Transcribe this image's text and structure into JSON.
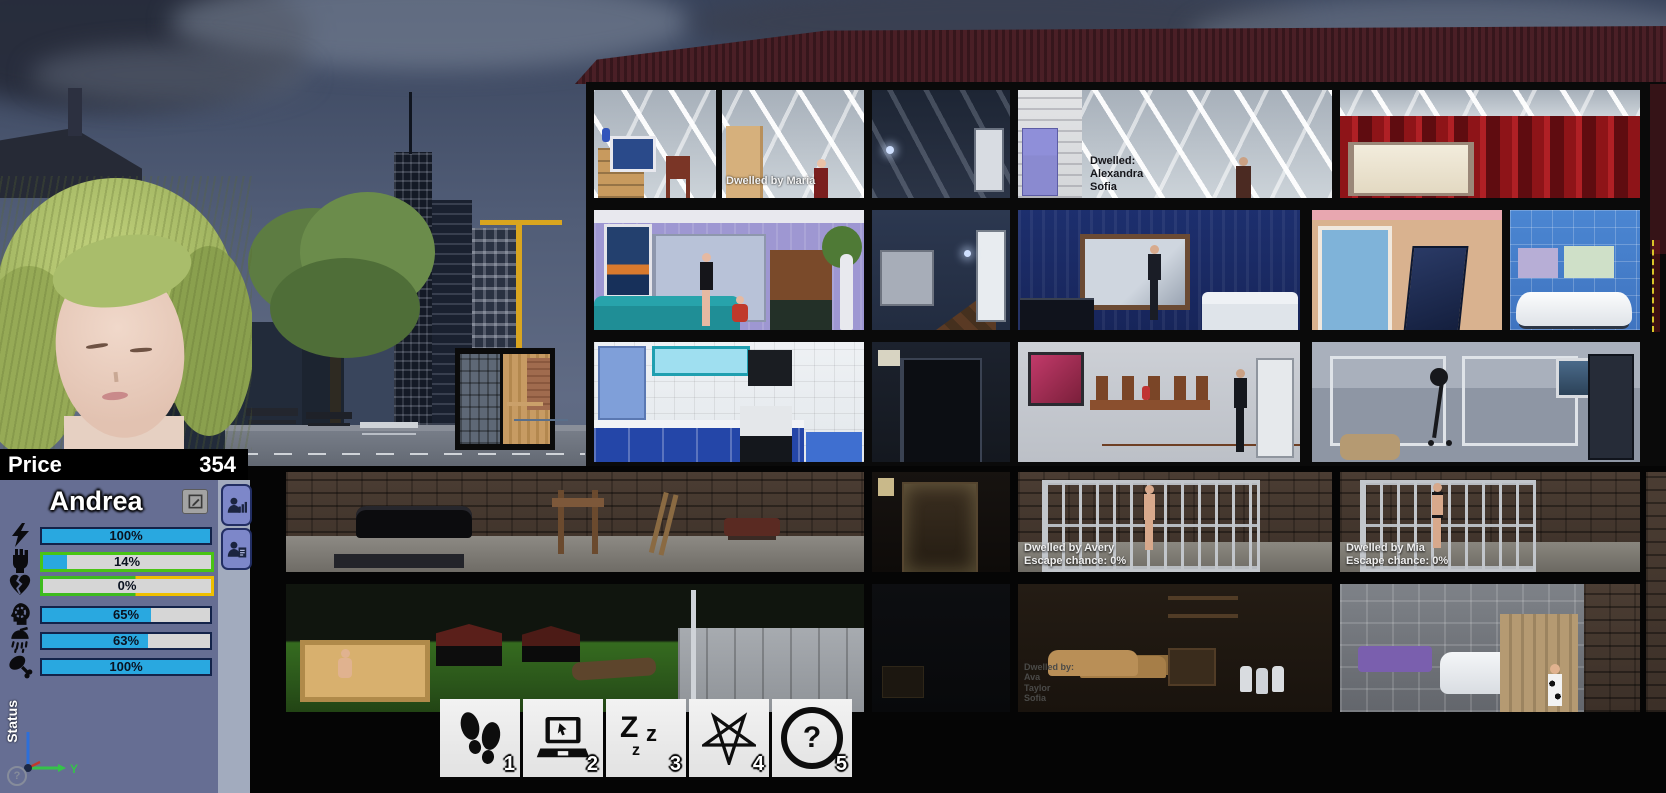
{
  "hud": {
    "price": {
      "label": "Price",
      "value": "354"
    },
    "character": {
      "name": "Andrea",
      "stats": [
        {
          "name": "energy",
          "icon": "lightning-icon",
          "value": "100%",
          "pct": 100
        },
        {
          "name": "obedience",
          "icon": "fist-icon",
          "value": "14%",
          "pct": 14
        },
        {
          "name": "affection",
          "icon": "broken-heart-icon",
          "value": "0%",
          "pct": 0
        },
        {
          "name": "psyche",
          "icon": "mind-gear-icon",
          "value": "65%",
          "pct": 65
        },
        {
          "name": "hygiene",
          "icon": "shower-icon",
          "value": "63%",
          "pct": 63
        },
        {
          "name": "food",
          "icon": "drumstick-icon",
          "value": "100%",
          "pct": 100
        }
      ]
    },
    "status_label": "Status",
    "axis_y_label": "Y",
    "help_glyph": "?"
  },
  "toolbar": {
    "buttons": [
      {
        "name": "walk",
        "icon": "footsteps-icon",
        "hotkey": "1"
      },
      {
        "name": "computer",
        "icon": "laptop-icon",
        "hotkey": "2"
      },
      {
        "name": "sleep",
        "icon": "sleep-zzz-icon",
        "hotkey": "3"
      },
      {
        "name": "ritual",
        "icon": "pentagram-icon",
        "hotkey": "4"
      },
      {
        "name": "help",
        "icon": "question-icon",
        "hotkey": "5"
      }
    ],
    "sleep_letters": [
      "Z",
      "z",
      "z"
    ],
    "question_glyph": "?"
  },
  "building": {
    "labels": {
      "attic_maria": "Dwelled by Maria",
      "attic_alexandra": "Dwelled:\nAlexandra\nSofia",
      "cage_avery": "Dwelled by Avery\nEscape chance: 0%",
      "cage_mia": "Dwelled by Mia\nEscape chance: 0%",
      "storage_dwellers": "Dwelled by:\nAva\nTaylor\nSofia"
    }
  },
  "colors": {
    "accent_blue": "#29a8e0",
    "bar_green": "#49c414",
    "bar_yellow": "#eebf00",
    "panel_bg": "#666e93",
    "strip_bg": "#a2abbe",
    "side_btn": "#7d87c9",
    "toolbar_btn": "#e2e2e2",
    "price_bg": "#000000",
    "roof": "#4a1f26"
  }
}
